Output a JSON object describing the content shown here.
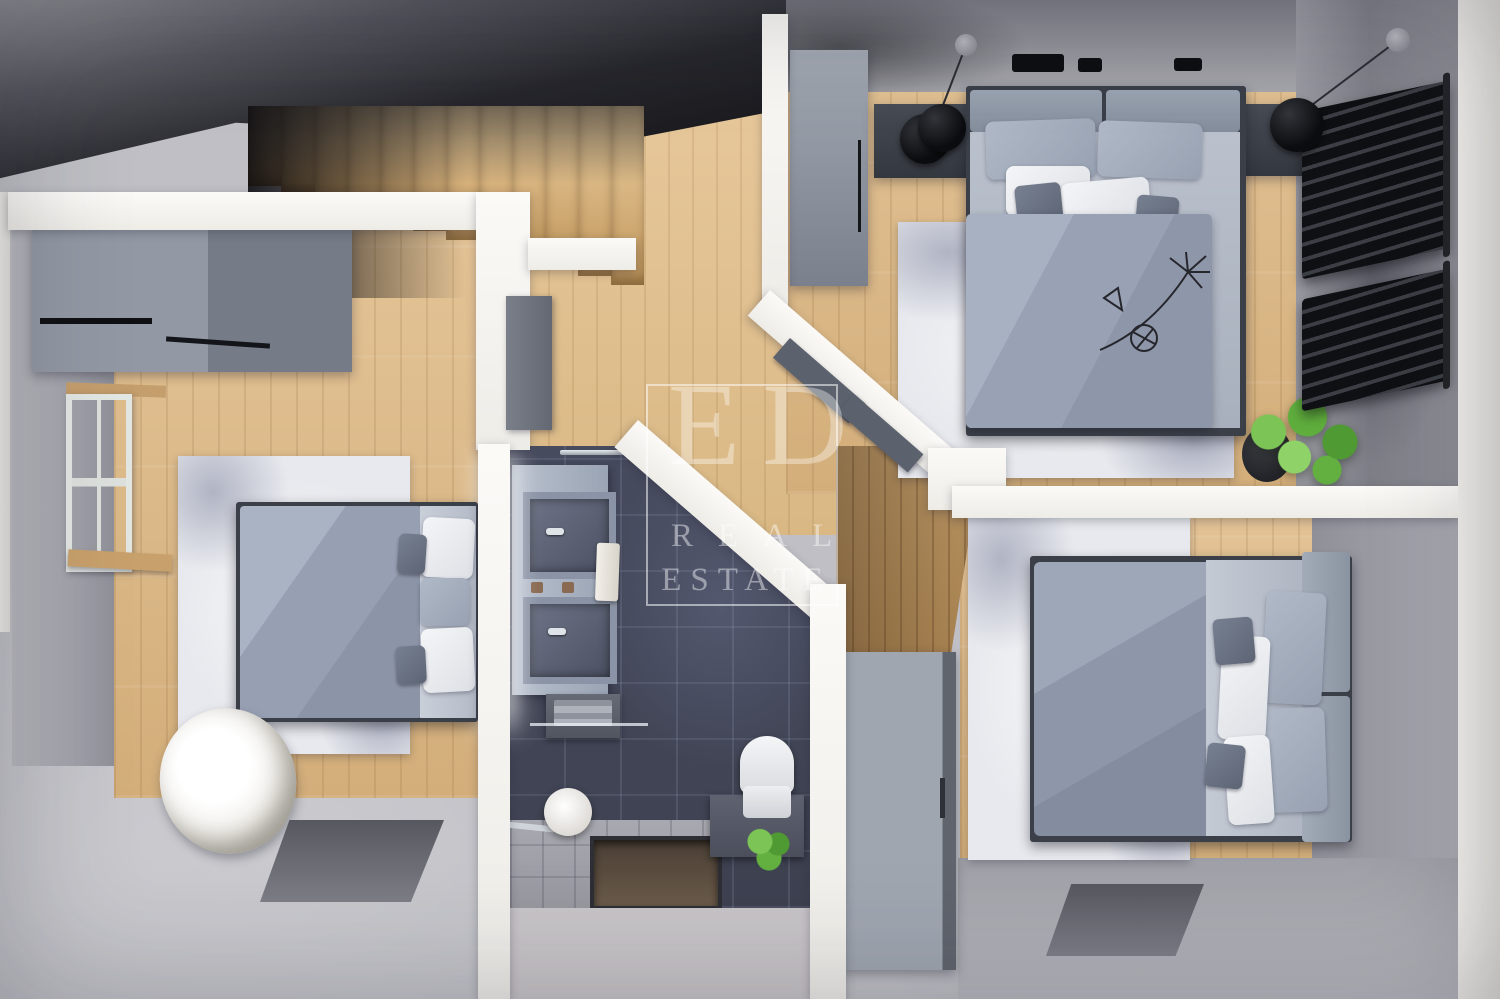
{
  "watermark": {
    "monogram": "ED",
    "line1": "REAL",
    "line2": "ESTATE"
  },
  "scene": {
    "type": "3d-top-down-floor-plan-render",
    "floor": "upper floor with stairwell",
    "rooms": [
      "bedroom-left",
      "bedroom-top-right",
      "bedroom-bottom-right",
      "bathroom",
      "stair-hallway"
    ],
    "inventory": [
      "staircase",
      "wardrobe-low",
      "window",
      "double-bed",
      "area-rug",
      "papasan-chair",
      "tall-wardrobe",
      "nightstand",
      "pendant-lamp",
      "wall-radiator",
      "potted-plant",
      "vanity-two-sinks",
      "mirror-light",
      "towel-shelf",
      "toilet",
      "shower-tray",
      "toilet-paper-holder",
      "storage-cabinet",
      "wire-flower-decor",
      "floor-cutout"
    ]
  },
  "palette": {
    "wall_white": "#f7f5f1",
    "wood_floor": "#dcbc8e",
    "wood_dark": "#c49a67",
    "concrete_light": "#bfbfc5",
    "concrete_mid": "#97979e",
    "void_dark": "#16161a",
    "tile_charcoal": "#454a5c",
    "furniture_gray": "#8f99a8",
    "bedding_gray": "#9aa3b4",
    "radiator_black": "#1d1e22",
    "rug_white": "#e7e9ee",
    "plant_green": "#5fae3d"
  }
}
